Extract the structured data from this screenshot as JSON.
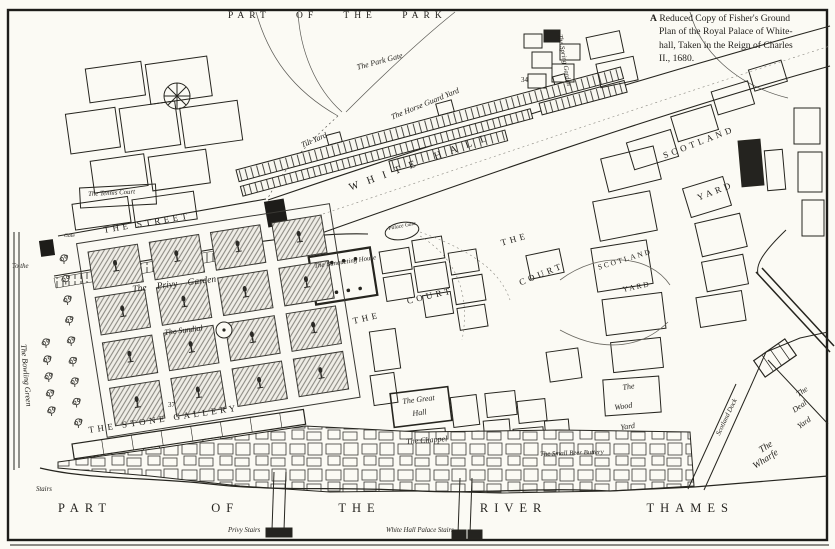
{
  "caption": {
    "lines": [
      "A Reduced Copy of Fisher's Ground",
      "Plan of the Royal Palace of White-",
      "hall, Taken in the Reign of Charles",
      "II., 1680."
    ]
  },
  "park_label": "PART OF THE PARK",
  "streets": {
    "white_hall": "WHITE HALL",
    "the_street": "THE STREET"
  },
  "yards": {
    "scotland_upper": {
      "line1": "SCOTLAND",
      "line2": "YARD"
    },
    "scotland_mid": {
      "line1": "SCOTLAND",
      "line2": "YARD"
    },
    "tilt_yard": "Tilt Yard",
    "horse_guard_yard": "The Horse Guard Yard",
    "wood_yard": {
      "line1": "The",
      "line2": "Wood",
      "line3": "Yard"
    },
    "deal_yard": {
      "line1": "The",
      "line2": "Deal",
      "line3": "Yard"
    },
    "the_wharfe": {
      "line1": "The",
      "line2": "Wharfe"
    },
    "scotland_dock": "Scotland Dock"
  },
  "courts": {
    "west": {
      "line1": "THE",
      "line2": "COURT"
    },
    "east": {
      "line1": "THE",
      "line2": "COURT"
    }
  },
  "garden": {
    "privy_garden": "The Privy Garden",
    "sundial": "The Sundial",
    "bowling_green": "The Bowling Green",
    "spring_garden": "The Spring Garden"
  },
  "buildings": {
    "tennis_court": "The Tennis Court",
    "banqueting_house": "The Banqueting House",
    "great_hall": {
      "line1": "The Great",
      "line2": "Hall"
    },
    "chappel": "The Chappel",
    "small_beer_buttery": "The Small Beer Buttery",
    "stone_gallery": "THE STONE GALLERY",
    "park_gate": "The Park Gate",
    "palace_gate": "Palace Gate"
  },
  "river": {
    "words": [
      "PART",
      "OF",
      "THE",
      "RIVER",
      "THAMES"
    ],
    "privy_stairs": "Privy Stairs",
    "palace_stairs": "White Hall Palace Stairs",
    "stairs": "Stairs"
  },
  "misc": {
    "to_the": "To the",
    "gate": "Gate",
    "num_34": "34",
    "num_37": "37"
  }
}
